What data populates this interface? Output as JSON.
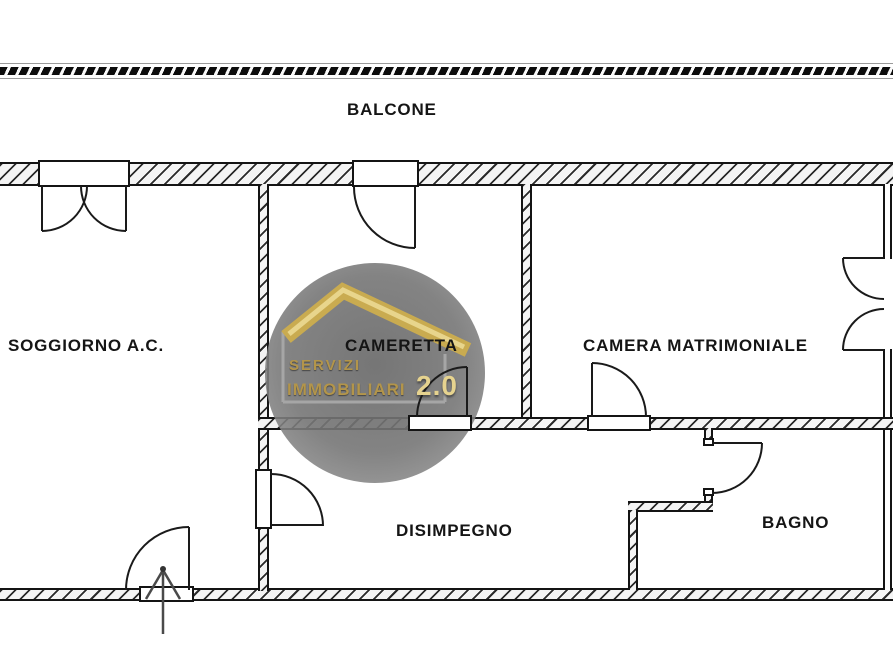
{
  "plan": {
    "type": "apartment-floorplan",
    "rooms": {
      "balcone": {
        "label": "BALCONE"
      },
      "soggiorno": {
        "label": "SOGGIORNO A.C."
      },
      "cameretta": {
        "label": "CAMERETTA"
      },
      "camera_matrimoniale": {
        "label": "CAMERA MATRIMONIALE"
      },
      "disimpegno": {
        "label": "DISIMPEGNO"
      },
      "bagno": {
        "label": "BAGNO"
      }
    },
    "features": {
      "balcony_railing": "hatched-railing-band",
      "entrance": "arrow-through-bottom-wall-into-soggiorno",
      "doors": [
        "double-french-door-soggiorno-to-balcone",
        "door-cameretta-to-balcone",
        "double-french-door-camera-matrimoniale-right-wall",
        "door-soggiorno-to-disimpegno",
        "door-cameretta-to-disimpegno",
        "door-camera-matrimoniale-to-disimpegno",
        "door-disimpegno-to-bagno",
        "entrance-door-soggiorno"
      ]
    }
  },
  "watermark": {
    "line1": "SERVIZI",
    "line2": "IMMOBILIARI",
    "version": "2.0",
    "icon": "house-roof-icon",
    "shape": "gray-circle-badge"
  },
  "colors": {
    "background": "#ffffff",
    "wall_line": "#141414",
    "wall_hatch_bg": "#f4f4f4",
    "railing_dash": "#0c0c0c",
    "watermark_circle": "#787878",
    "logo_gold": "#d2b564",
    "logo_gold_text": "#b3954a",
    "logo_gold_light": "#e6d38f",
    "label_text": "#151515",
    "entrance_arrow": "#4a4a4a"
  }
}
